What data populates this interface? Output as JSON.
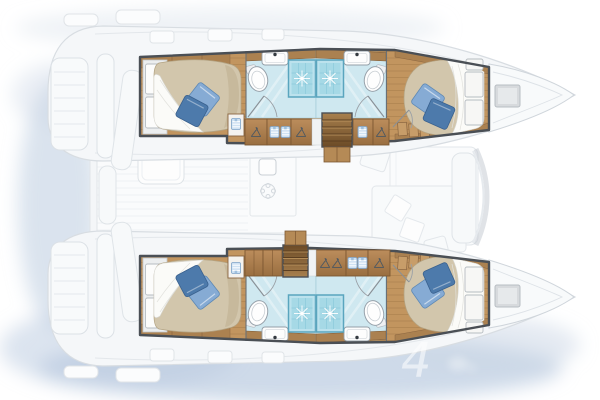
{
  "page": {
    "title": "catamaran-layout-floorplan",
    "background": "#ffffff",
    "watermark_character": "4"
  },
  "palette": {
    "wood_floor": "#c2955f",
    "wood_cabinet_light": "#bc8d5c",
    "wood_cabinet_dark": "#996e40",
    "wood_band": "#ab8150",
    "stair_dark": "#6b4a26",
    "mattress": "#d2c6ac",
    "sheet_white": "#fbfbf8",
    "pillow_light": "#86abd4",
    "pillow_dark": "#4d7aab",
    "bath_tile": "#cfe8f0",
    "shower_tile": "#a6d9e6",
    "shower_frame": "#5aa5be",
    "fixture_white": "#fdfdfd",
    "frame_line": "#4a4f55",
    "ghost_fill": "#f6f8fa",
    "ghost_line": "#dde2e7",
    "shadow_blue": "#b9cadf",
    "linen_icon_blue": "#cfe2f3"
  },
  "floorplan": {
    "view": "overhead-deck-plan",
    "vessel_type": "sailing-catamaran",
    "symmetry": "twin-hull-mirrored",
    "hulls": [
      {
        "id": "upper-hull",
        "bow": "right",
        "stern": "left",
        "rooms": [
          {
            "name": "aft-cabin",
            "objects": [
              "double-berth",
              "white-bed-sheet",
              "pillow-light-blue",
              "pillow-dark-blue",
              "wardrobe-doors",
              "storage-shelf",
              "linen-locker"
            ]
          },
          {
            "name": "aft-bathroom",
            "objects": [
              "shower-cubicle",
              "washbasin",
              "toilet",
              "door-swing"
            ]
          },
          {
            "name": "forward-bathroom",
            "objects": [
              "shower-cubicle",
              "washbasin",
              "toilet",
              "door-swing"
            ]
          },
          {
            "name": "forward-cabin",
            "objects": [
              "island-double-berth",
              "white-bed-sheet",
              "pillow-light-blue",
              "pillow-dark-blue",
              "headboard-panels",
              "storage-drawers",
              "door-swing"
            ]
          },
          {
            "name": "companionway",
            "objects": [
              "stair-steps",
              "hanger-lockers",
              "linen-shelves"
            ]
          }
        ]
      },
      {
        "id": "lower-hull",
        "bow": "right",
        "stern": "left",
        "rooms": [
          {
            "name": "aft-cabin",
            "objects": [
              "double-berth",
              "white-bed-sheet",
              "pillow-light-blue",
              "pillow-dark-blue",
              "wardrobe-doors",
              "storage-shelf",
              "linen-locker"
            ]
          },
          {
            "name": "aft-bathroom",
            "objects": [
              "shower-cubicle",
              "washbasin",
              "toilet",
              "door-swing"
            ]
          },
          {
            "name": "forward-bathroom",
            "objects": [
              "shower-cubicle",
              "washbasin",
              "toilet",
              "door-swing"
            ]
          },
          {
            "name": "forward-cabin",
            "objects": [
              "island-double-berth",
              "white-bed-sheet",
              "pillow-light-blue",
              "pillow-dark-blue",
              "headboard-panels",
              "storage-drawers",
              "door-swing"
            ]
          },
          {
            "name": "companionway",
            "objects": [
              "stair-steps",
              "hanger-lockers",
              "linen-shelves"
            ]
          }
        ]
      }
    ],
    "center_deck_ghosted": {
      "cockpit": [
        "cockpit-table",
        "bench-seat",
        "aft-galley-units",
        "grill"
      ],
      "salon": [
        "galley-fridge",
        "galley-sink",
        "galley-stove",
        "dinette-sofa",
        "salon-table",
        "nav-seat",
        "windshield"
      ],
      "exterior": [
        "transom-steps",
        "davits",
        "bow-deck-hatch",
        "foredeck"
      ]
    }
  }
}
